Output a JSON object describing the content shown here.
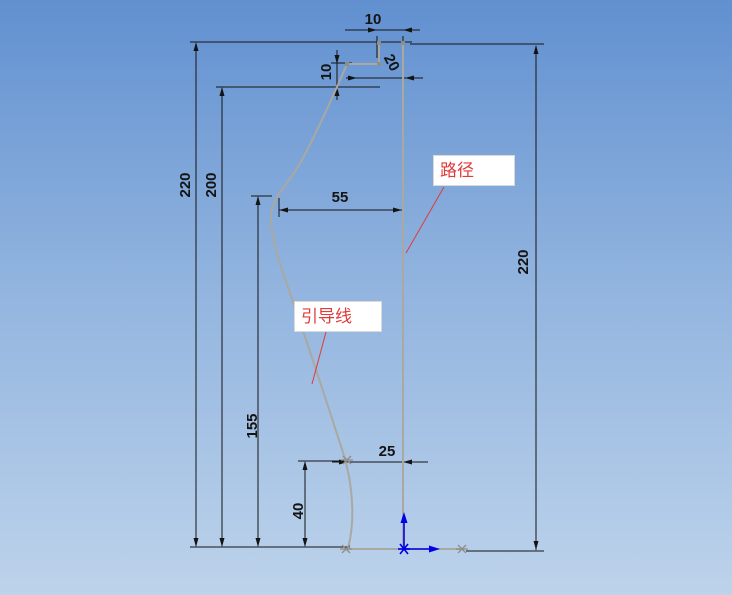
{
  "view": {
    "description": "CAD sketch viewport with sweep path and guide curve",
    "background_top_color": "#6190d0",
    "background_bottom_color": "#bdd3eb",
    "sketch_line_color": "#a9a9a2",
    "dimension_color": "#141414",
    "origin_color": "#0000e6",
    "annotation_color": "#e03a3a"
  },
  "annotations": {
    "path_label": "路径",
    "guide_label": "引导线"
  },
  "dimensions": {
    "top_gap": "10",
    "neck_offset": "20",
    "upper_step": "10",
    "total_height_left": "220",
    "upper_point_height": "200",
    "bulge_width": "55",
    "lower_point_height": "155",
    "bottom_step_height": "40",
    "bottom_gap": "25",
    "path_length": "220"
  }
}
